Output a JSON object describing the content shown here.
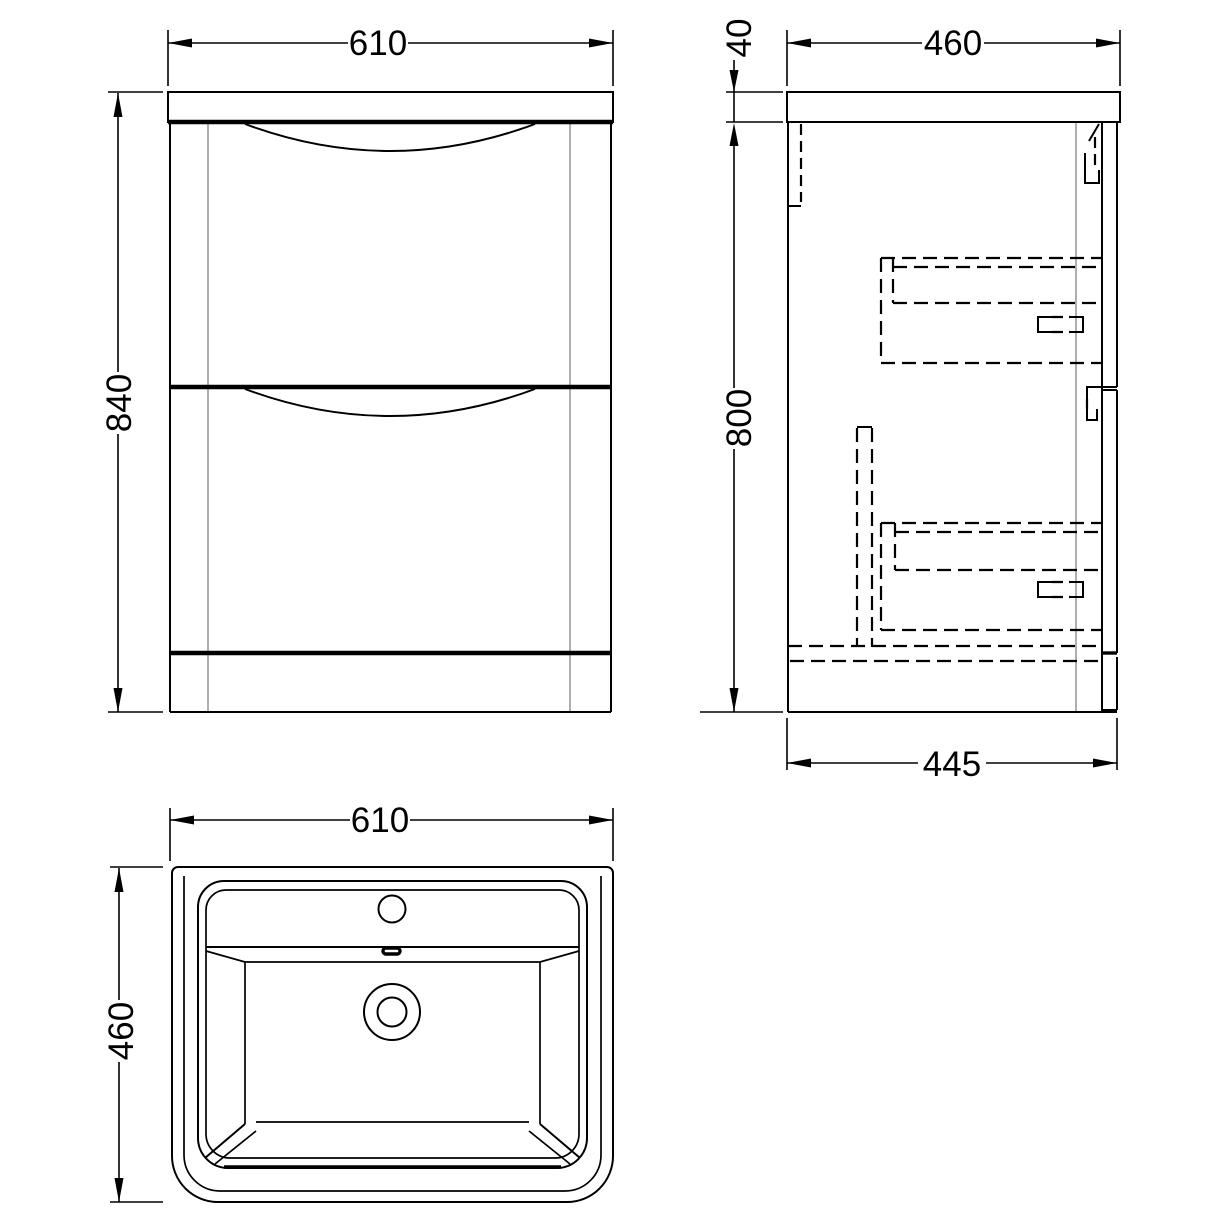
{
  "drawing": {
    "description": "three-view technical drawing of a two-drawer floor-standing vanity unit with basin",
    "colors": {
      "line": "#000000",
      "gray": "#9b9b9b",
      "background": "#ffffff"
    },
    "views": {
      "front": {
        "width_label": "610",
        "height_label": "840"
      },
      "side": {
        "worktop_thickness_label": "40",
        "depth_label": "460",
        "height_label": "800",
        "base_depth_label": "445"
      },
      "plan": {
        "width_label": "610",
        "depth_label": "460"
      }
    }
  }
}
